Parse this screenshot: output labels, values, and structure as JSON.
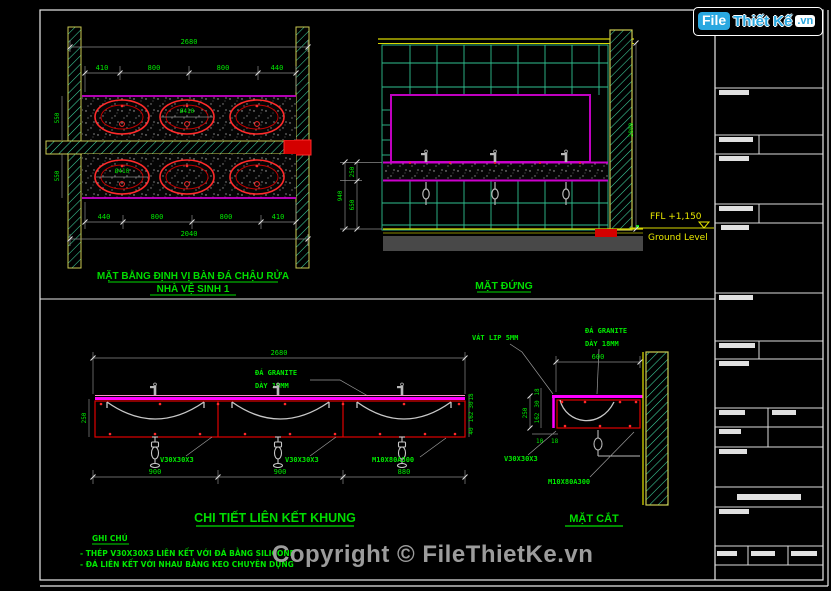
{
  "branding": {
    "logo_part1": "File",
    "logo_part2": "Thiết Kế",
    "logo_part3": ".vn"
  },
  "titles": {
    "plan_line1": "MẶT BẰNG ĐỊNH VỊ BÀN ĐÁ CHẬU RỬA",
    "plan_line2": "NHÀ VỆ SINH 1",
    "elevation": "MẶT ĐỨNG",
    "detail": "CHI TIẾT LIÊN KẾT KHUNG",
    "section": "MẶT CẮT"
  },
  "materials": {
    "granite_line1": "ĐÁ GRANITE",
    "granite_line2": "DÀY 18MM",
    "angle_steel": "V30X30X3",
    "bolt": "M10X80A300",
    "chamfer": "VÁT LIP 5MM"
  },
  "plan": {
    "overall_top": "2680",
    "top_segments": [
      "410",
      "800",
      "800",
      "440"
    ],
    "bottom_segments": [
      "440",
      "800",
      "800",
      "410"
    ],
    "overall_bottom": "2040",
    "depth": "550",
    "basin_dia": "Ø410"
  },
  "elevation": {
    "ffl": "FFL +1,150",
    "ground": "Ground Level",
    "height_total": "2800",
    "band_height": "250",
    "below_height": "650",
    "counter_height": "940"
  },
  "detail": {
    "overall": "2680",
    "segments": [
      "900",
      "900",
      "880"
    ],
    "side_height": "250",
    "right_chain": [
      "18",
      "30",
      "162",
      "40"
    ]
  },
  "section": {
    "width": "600",
    "side_height": "250",
    "left_chain": [
      "18",
      "30",
      "162"
    ],
    "small_dims": [
      "10",
      "18"
    ]
  },
  "notes": {
    "heading": "GHI CHÚ",
    "line1": "- THÉP V30X30X3 LIÊN KẾT VỚI ĐÁ BẰNG SILICONE",
    "line2": "- ĐÁ LIÊN KẾT VỚI NHAU BẰNG KEO CHUYÊN DỤNG"
  },
  "copyright": {
    "text": "Copyright © FileThietKe.vn"
  },
  "colors": {
    "dim_green": "#00e800",
    "magenta": "#cc00cc",
    "counter_pink": "#ff00ff",
    "red": "#ff2a2a",
    "yellow": "#d8d800",
    "tile_green": "#3fd6a0",
    "wall_khaki": "#caca52",
    "logo_blue": "#2aa8e0",
    "copyright_gray": "#9c9c9c"
  }
}
